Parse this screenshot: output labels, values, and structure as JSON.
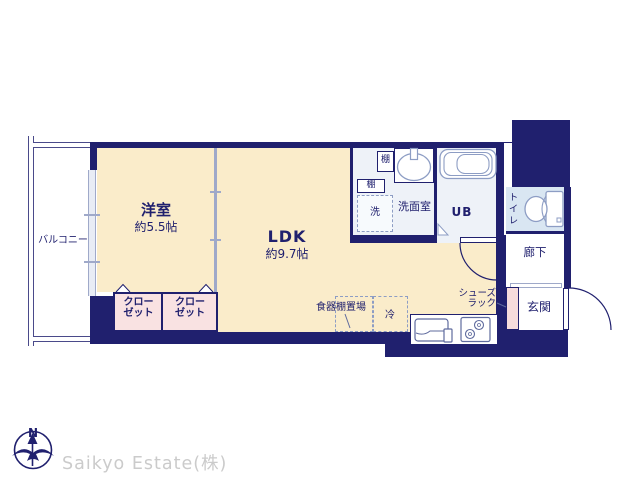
{
  "branding": {
    "company": "Saikyo Estate(株)",
    "compass_label": "N"
  },
  "colors": {
    "wall_navy": "#20206e",
    "room_cream": "#faecca",
    "closet_pink": "#f9e2e2",
    "toilet_blue": "#d9e6f2",
    "bath_tint": "#eef2f8",
    "line_blue": "#9fa9c9",
    "watermark_gray": "#cbcbcb"
  },
  "rooms": {
    "balcony": {
      "label": "バルコニー"
    },
    "western": {
      "label": "洋室",
      "size": "約5.5帖"
    },
    "ldk": {
      "label": "LDK",
      "size": "約9.7帖"
    },
    "closet_left": {
      "line1": "クロー",
      "line2": "ゼット"
    },
    "closet_right": {
      "line1": "クロー",
      "line2": "ゼット"
    },
    "washroom": {
      "label": "洗面室"
    },
    "unit_bath": {
      "label": "UB"
    },
    "toilet": {
      "label": "トイレ"
    },
    "corridor": {
      "label": "廊下"
    },
    "entrance": {
      "label": "玄関"
    }
  },
  "fixtures": {
    "shelf_top": {
      "label": "棚"
    },
    "shelf_side": {
      "label": "棚"
    },
    "washer": {
      "label": "洗"
    },
    "fridge": {
      "label": "冷"
    },
    "dish_shelf": {
      "label": "食器棚置場"
    },
    "shoe_rack": {
      "line1": "シューズ",
      "line2": "ラック"
    }
  }
}
